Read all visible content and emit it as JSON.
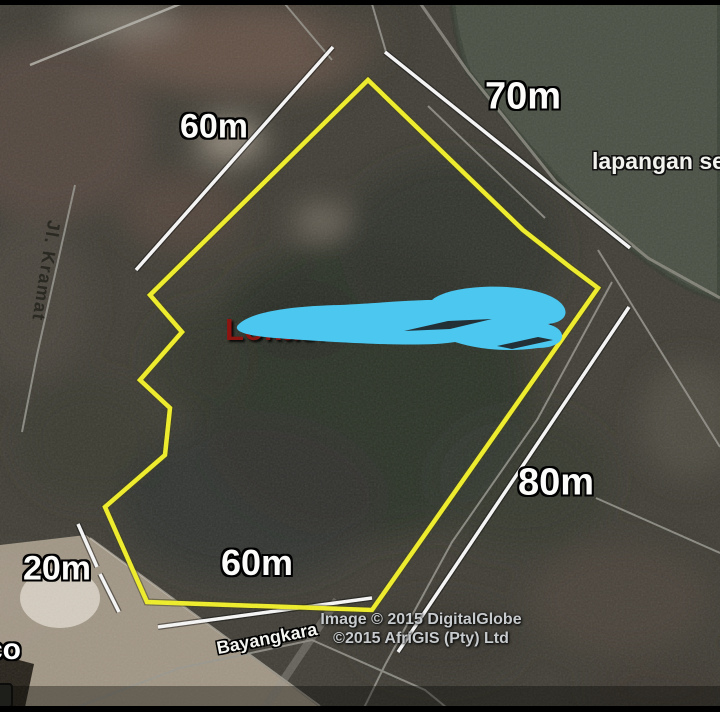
{
  "map_overlay": {
    "measurements": [
      {
        "position": "top-left",
        "label": "60m"
      },
      {
        "position": "top-right",
        "label": "70m"
      },
      {
        "position": "right",
        "label": "80m"
      },
      {
        "position": "bottom",
        "label": "60m"
      },
      {
        "position": "bottom-left",
        "label": "20m"
      }
    ],
    "location_label": {
      "left_fragment": "Lokasi Tan",
      "right_fragment": "m2"
    },
    "place_labels": {
      "field": "lapangan sec",
      "street_left": "Jl. Kramat",
      "street_bottom": "Bayangkara",
      "corner_partial": "co"
    },
    "attribution": {
      "line1": "Image © 2015 DigitalGlobe",
      "line2": "©2015 AfriGIS (Pty) Ltd"
    },
    "status_bar": {
      "imagery_date": "Imagery Date: 6/2/2015",
      "coordinates": "6°54'34.78\" S  10"
    },
    "colors": {
      "parcel_outline": "#f1ef25",
      "measure_line": "#f8f8f8",
      "scribble": "#4bc7f0",
      "location_text": "#8c1511",
      "field_green": "#4a5044",
      "road_gray": "#97968e"
    }
  }
}
